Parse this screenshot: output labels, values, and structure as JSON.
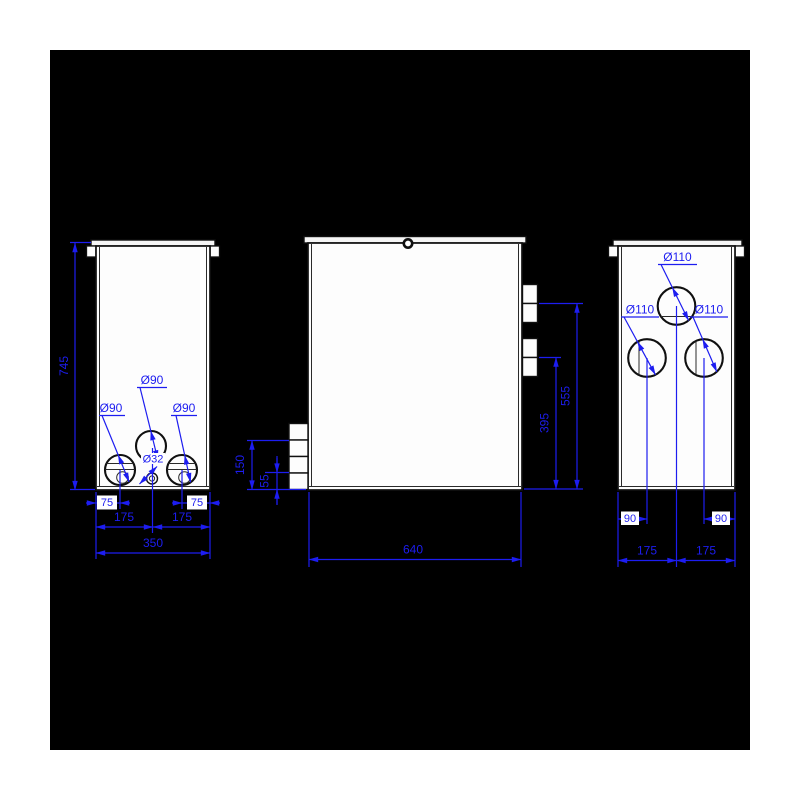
{
  "title": "Tank technical drawing — three orthographic views with dimensions (mm)",
  "colors": {
    "page_background": "#ffffff",
    "panel_background": "#000000",
    "outline": "#101010",
    "dimension": "#1d1df0",
    "body_fill": "#fdfdfd"
  },
  "views": {
    "left_side": {
      "overall_height": "745",
      "hole_mid": "Ø90",
      "hole_left": "Ø90",
      "hole_right": "Ø90",
      "hole_small": "Ø32",
      "dim_offset_left": "75",
      "dim_offset_right": "75",
      "dim_half_left": "175",
      "dim_half_right": "175",
      "dim_width": "350"
    },
    "front": {
      "dim_width": "640",
      "dim_right_upper": "555",
      "dim_right_lower": "395",
      "dim_left_upper": "150",
      "dim_left_lower": "55"
    },
    "right_side": {
      "hole_top": "Ø110",
      "hole_left": "Ø110",
      "hole_right": "Ø110",
      "dim_offset_left": "90",
      "dim_offset_right": "90",
      "dim_half_left": "175",
      "dim_half_right": "175"
    }
  }
}
